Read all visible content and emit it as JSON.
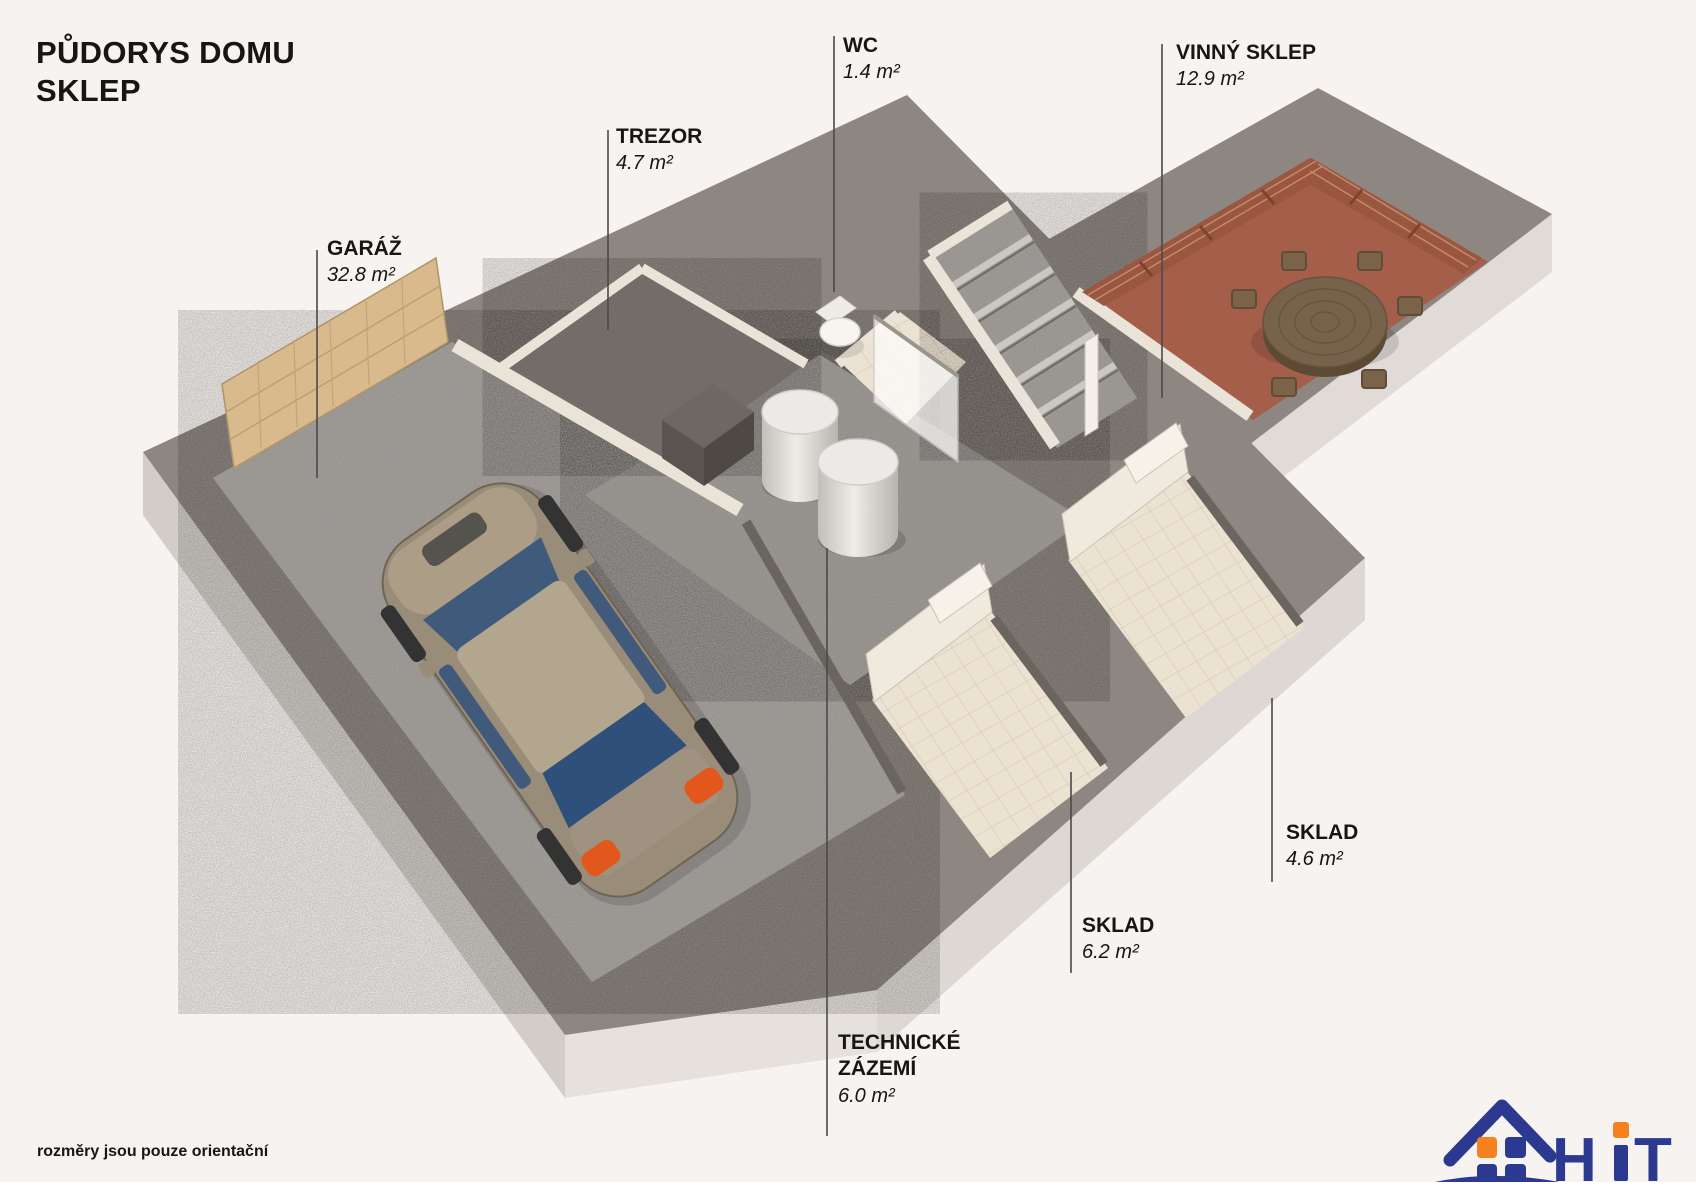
{
  "title": {
    "line1": "PŮDORYS DOMU",
    "line2": "SKLEP"
  },
  "disclaimer": "rozměry jsou pouze orientační",
  "rooms": [
    {
      "id": "garaz",
      "name": "GARÁŽ",
      "area": "32.8 m²"
    },
    {
      "id": "trezor",
      "name": "TREZOR",
      "area": "4.7 m²"
    },
    {
      "id": "wc",
      "name": "WC",
      "area": "1.4 m²"
    },
    {
      "id": "vinny-sklep",
      "name": "VINNÝ SKLEP",
      "area": "12.9 m²"
    },
    {
      "id": "sklad-4-6",
      "name": "SKLAD",
      "area": "4.6 m²"
    },
    {
      "id": "sklad-6-2",
      "name": "SKLAD",
      "area": "6.2 m²"
    },
    {
      "id": "technicke-zazemi",
      "name": "TECHNICKÉ",
      "name2": "ZÁZEMÍ",
      "area": "6.0 m²"
    }
  ],
  "logo": {
    "name": "HiT",
    "letters": [
      "H",
      "i",
      "T"
    ],
    "reality": "REALITY",
    "blue": "#2b3990",
    "orange": "#f5821f"
  },
  "colors": {
    "background": "#f7f3f0",
    "wall_top": "#8e8781",
    "wall_face_left": "#d2cdc8",
    "wall_face_right": "#ddd8d3",
    "concrete": "#a6a29e",
    "concrete_center": "#a09c98",
    "trezor_floor": "#7b7571",
    "tile": "#ece2d1",
    "wine_floor": "#a45e4a",
    "brick": "#9a563f",
    "wood_wall": "#d9ba8c",
    "cream_wall": "#eae3d7",
    "car_body": "#998c78",
    "car_glass": "#3f5a7a",
    "car_light": "#e2571b",
    "leader_line": "#4a4a4a",
    "text": "#161616"
  }
}
